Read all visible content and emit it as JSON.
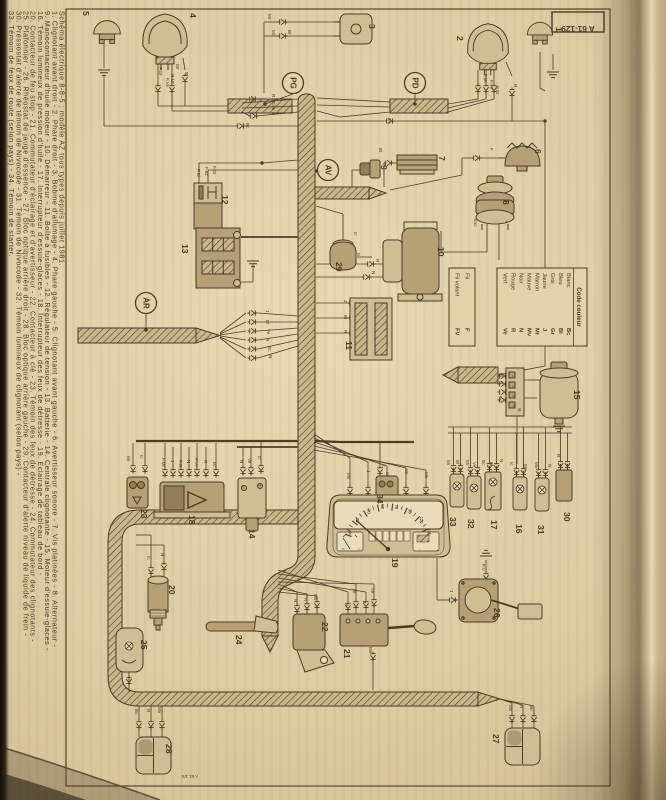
{
  "page": {
    "ref_tab": "A 61-129",
    "print_mark": "A 61 1/4"
  },
  "caption": {
    "title": "Schéma électrique 8-8-5 ; modèle AZ tous types depuis juillet 1981.",
    "lines": [
      "1. Clignotant avant droit - 2. Phare droit - 3. Bobine d'allumage - 4. Phare gauche - 5. Clignotant avant gauche - 6. Avertisseur sonore - 7. Vis platinées - 8. Alternateur -",
      "9. Manocontacteur d'huile moteur - 10. Démarreur - 11. Boîte à fusibles - 12. Régulateur de tension - 13. Batterie - 14. Centrale clignotante - 15. Moteur d'essuie-glaces -",
      "16. Témoin lumineux de pression d'huile - 17. Interrupteur d'essuie-glaces - 18. Interrupteur des feux de détresse - 19. Éclairage de tableau de bord -",
      "20. Contacteur de feu stop - 21. Commutateur d'éclairage et d'avertisseur - 22. Contacteur à clé - 23. Témoin des feux de détresse - 24. Commutateur des clignotants -",
      "25. Plafonnier - 26. Rhéostat de jauge d'essence - 27. Bloc optique arrière droit - 28. Bloc optique arrière gauche - 29. Contacteur d'alerte niveau de liquide de frein -",
      "30. Pressostat d'alerte de témoin de Nivocode - 31. Témoin de Nivocode - 32. Témoin lumineux de clignotant (selon pays) -",
      "33. Témoin de feux de route (selon pays) - 34. Témoin de starter."
    ]
  },
  "color_code": {
    "header": "Code couleur",
    "entries": [
      [
        "Blanc",
        "Bc"
      ],
      [
        "Bleu",
        "Bl"
      ],
      [
        "Gris",
        "Gr"
      ],
      [
        "Jaune",
        "J"
      ],
      [
        "Marron",
        "Mr"
      ],
      [
        "Mauve",
        "Mv"
      ],
      [
        "Noir",
        "N"
      ],
      [
        "Rouge",
        "R"
      ],
      [
        "Vert",
        "Ve"
      ]
    ],
    "wire_rows": [
      [
        "Fil",
        "F"
      ],
      [
        "Fil volant",
        "FV"
      ]
    ]
  },
  "zones": [
    {
      "t": "PG",
      "x": 293,
      "y": 83
    },
    {
      "t": "PD",
      "x": 415,
      "y": 83
    },
    {
      "t": "AV",
      "x": 328,
      "y": 170
    },
    {
      "t": "AR",
      "x": 146,
      "y": 303
    }
  ],
  "numbers": [
    [
      "1",
      556,
      27
    ],
    [
      "2",
      457,
      36
    ],
    [
      "3",
      369,
      24
    ],
    [
      "4",
      190,
      13
    ],
    [
      "5",
      83,
      11
    ],
    [
      "6",
      535,
      149
    ],
    [
      "7",
      439,
      156
    ],
    [
      "8",
      503,
      200
    ],
    [
      "9",
      381,
      165
    ],
    [
      "10",
      438,
      247
    ],
    [
      "11",
      346,
      341
    ],
    [
      "12",
      222,
      195
    ],
    [
      "13",
      182,
      244
    ],
    [
      "14",
      249,
      529
    ],
    [
      "15",
      574,
      390
    ],
    [
      "16",
      516,
      524
    ],
    [
      "17",
      491,
      520
    ],
    [
      "18",
      189,
      515
    ],
    [
      "19",
      392,
      558
    ],
    [
      "20",
      169,
      585
    ],
    [
      "21",
      344,
      649
    ],
    [
      "22",
      322,
      622
    ],
    [
      "23",
      141,
      509
    ],
    [
      "24",
      236,
      635
    ],
    [
      "25",
      141,
      640
    ],
    [
      "26",
      494,
      608
    ],
    [
      "27",
      493,
      734
    ],
    [
      "28",
      166,
      744
    ],
    [
      "29",
      336,
      262
    ],
    [
      "30",
      564,
      512
    ],
    [
      "31",
      538,
      525
    ],
    [
      "32",
      468,
      519
    ],
    [
      "33",
      450,
      517
    ],
    [
      "34",
      377,
      494
    ]
  ],
  "wire_labels": [
    [
      "F.Gr",
      159,
      67
    ],
    [
      "F.Ve",
      166,
      78
    ],
    [
      "Mr",
      176,
      64
    ],
    [
      "R.Mr",
      171,
      74
    ],
    [
      "R",
      185,
      72
    ],
    [
      "R.Mr.Ve",
      272,
      94
    ],
    [
      "J",
      272,
      112
    ],
    [
      "Bc",
      246,
      123
    ],
    [
      "Mr",
      268,
      14
    ],
    [
      "Mr",
      272,
      30
    ],
    [
      "Bl",
      288,
      30
    ],
    [
      "F.Mr",
      484,
      74
    ],
    [
      "F.Ve",
      490,
      80
    ],
    [
      "F.Gr",
      496,
      86
    ],
    [
      "R",
      514,
      84
    ],
    [
      "Bc",
      388,
      118
    ],
    [
      "F",
      490,
      148
    ],
    [
      "Bl",
      379,
      148
    ],
    [
      "Exc",
      474,
      219
    ],
    [
      "+",
      505,
      220
    ],
    [
      "Ic",
      354,
      232
    ],
    [
      "Mr",
      357,
      253
    ],
    [
      "R",
      376,
      259
    ],
    [
      "N",
      372,
      271
    ],
    [
      "F.Bl",
      197,
      169
    ],
    [
      "F.Bc",
      205,
      167
    ],
    [
      "F.Gr",
      213,
      166
    ],
    [
      "J",
      344,
      300
    ],
    [
      "Bl",
      344,
      315
    ],
    [
      "R",
      344,
      330
    ],
    [
      "J",
      266,
      310
    ],
    [
      "Bl",
      266,
      320
    ],
    [
      "Ve",
      267,
      329
    ],
    [
      "R",
      266,
      338
    ],
    [
      "Bc",
      268,
      346
    ],
    [
      "N",
      269,
      355
    ],
    [
      "Bl",
      500,
      373
    ],
    [
      "N",
      500,
      381
    ],
    [
      "Bc",
      499,
      396
    ],
    [
      "N",
      518,
      408
    ],
    [
      "Mv",
      347,
      473
    ],
    [
      "J",
      367,
      470
    ],
    [
      "Ic",
      386,
      472
    ],
    [
      "Mr",
      405,
      469
    ],
    [
      "Mv",
      425,
      472
    ],
    [
      "Mr",
      447,
      460
    ],
    [
      "Bl",
      456,
      460
    ],
    [
      "Mr",
      466,
      460
    ],
    [
      "Ve",
      473,
      462
    ],
    [
      "Bc",
      482,
      460
    ],
    [
      "Bl",
      490,
      462
    ],
    [
      "N",
      500,
      459
    ],
    [
      "Ic",
      510,
      462
    ],
    [
      "Mv",
      524,
      464
    ],
    [
      "Mv",
      535,
      462
    ],
    [
      "R",
      548,
      464
    ],
    [
      "R",
      557,
      454
    ],
    [
      "Ic",
      382,
      464
    ],
    [
      "Mr",
      127,
      456
    ],
    [
      "Ic",
      140,
      455
    ],
    [
      "F.Mr",
      162,
      458
    ],
    [
      "J",
      171,
      460
    ],
    [
      "F.Gr",
      179,
      460
    ],
    [
      "N",
      187,
      460
    ],
    [
      "F.Ve",
      195,
      458
    ],
    [
      "R",
      204,
      460
    ],
    [
      "Bc",
      213,
      462
    ],
    [
      "N",
      240,
      460
    ],
    [
      "Ve",
      248,
      458
    ],
    [
      "Ic",
      258,
      456
    ],
    [
      "+",
      241,
      485
    ],
    [
      "C",
      258,
      483
    ],
    [
      "Ic",
      147,
      556
    ],
    [
      "N",
      161,
      553
    ],
    [
      "N",
      294,
      599
    ],
    [
      "R",
      304,
      598
    ],
    [
      "Mv",
      314,
      594
    ],
    [
      "N",
      345,
      603
    ],
    [
      "Bl",
      353,
      589
    ],
    [
      "J",
      363,
      601
    ],
    [
      "Ve",
      371,
      588
    ],
    [
      "Mv",
      369,
      647
    ],
    [
      "F.V",
      482,
      564
    ],
    [
      "J",
      450,
      590
    ],
    [
      "Mv",
      509,
      705
    ],
    [
      "R",
      520,
      705
    ],
    [
      "Bc",
      530,
      706
    ],
    [
      "Bc",
      135,
      709
    ],
    [
      "R",
      147,
      709
    ],
    [
      "Mv",
      158,
      707
    ]
  ],
  "cluster": {
    "dial": [
      "0",
      "10",
      "30",
      "50",
      "70",
      "90",
      "110",
      "130"
    ],
    "fuel_marks": [
      "0",
      "1"
    ],
    "battery_marks": [
      "-",
      "+"
    ]
  },
  "wiper_pins": [
    "1",
    "2",
    "3",
    "4"
  ]
}
